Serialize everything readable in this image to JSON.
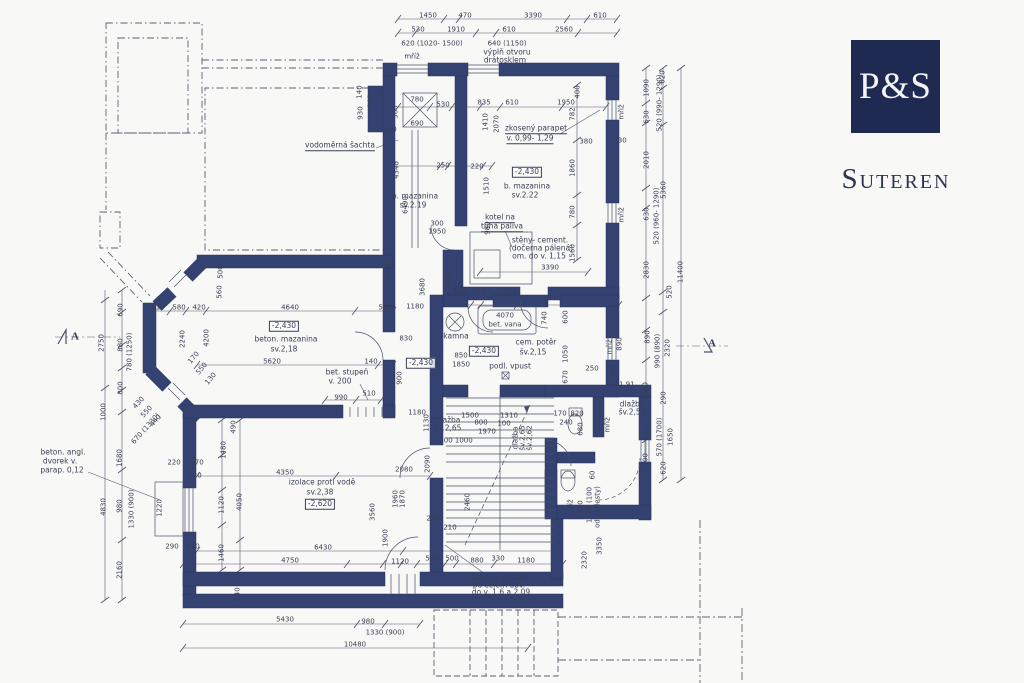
{
  "branding": {
    "monogram": "P&S",
    "title": "Suteren"
  },
  "colors": {
    "wall": "#344271",
    "line": "#565b6e",
    "logo_bg": "#1f2a52",
    "text": "#3a3f55"
  },
  "plan": {
    "texts": [
      [
        "1450",
        428,
        16
      ],
      [
        "470",
        465,
        16
      ],
      [
        "3390",
        533,
        16
      ],
      [
        "610",
        600,
        16
      ],
      [
        "530",
        418,
        30
      ],
      [
        "1910",
        456,
        30
      ],
      [
        "610",
        509,
        30
      ],
      [
        "2560",
        564,
        30
      ],
      [
        "620 (1020- 1500)",
        432,
        44
      ],
      [
        "640 (1150)",
        507,
        44
      ],
      [
        "výplň otvoru",
        507,
        52,
        0,
        "L"
      ],
      [
        "drátosklem",
        505,
        60,
        0,
        "L"
      ],
      [
        "mříž",
        412,
        57
      ],
      [
        "140",
        381,
        95,
        -90
      ],
      [
        "360",
        396,
        112,
        -90
      ],
      [
        "780",
        417,
        100
      ],
      [
        "690",
        417,
        124
      ],
      [
        "530",
        443,
        105
      ],
      [
        "835",
        484,
        103
      ],
      [
        "610",
        512,
        103
      ],
      [
        "1950",
        566,
        103
      ],
      [
        "400",
        578,
        92,
        -90
      ],
      [
        "782",
        573,
        114,
        -90
      ],
      [
        "1410",
        486,
        122,
        -90
      ],
      [
        "2070",
        497,
        124,
        -90
      ],
      [
        "100",
        390,
        130
      ],
      [
        "4340",
        397,
        170,
        -90
      ],
      [
        "6490",
        406,
        205,
        -90
      ],
      [
        "250",
        443,
        166
      ],
      [
        "220",
        477,
        167
      ],
      [
        "1510",
        487,
        186,
        -90
      ],
      [
        "1860",
        573,
        168,
        -90
      ],
      [
        "780",
        573,
        212,
        -90
      ],
      [
        "980",
        488,
        228,
        -90
      ],
      [
        "1560",
        573,
        253,
        -90
      ],
      [
        "300",
        437,
        224
      ],
      [
        "1950",
        437,
        232
      ],
      [
        "3390",
        550,
        268
      ],
      [
        "140",
        360,
        92,
        -90
      ],
      [
        "930",
        361,
        113,
        -90
      ],
      [
        "140",
        371,
        101,
        -90
      ],
      [
        "vodoměrná šachta",
        340,
        146,
        0,
        "Lu"
      ],
      [
        "zkosený parapet",
        536,
        129,
        0,
        "Lu"
      ],
      [
        "v. 0,99- 1,29",
        530,
        139,
        0,
        "Lu"
      ],
      [
        "380",
        586,
        142
      ],
      [
        "230",
        620,
        141
      ],
      [
        "b. mazanina",
        415,
        196,
        0,
        "L"
      ],
      [
        "sv.2.19",
        413,
        205,
        0,
        "L"
      ],
      [
        "-2,430",
        527,
        172,
        0,
        "b"
      ],
      [
        "b. mazanina",
        527,
        186,
        0,
        "L"
      ],
      [
        "sv.2.22",
        525,
        195,
        0,
        "L"
      ],
      [
        "kotel na",
        500,
        218,
        0,
        "Lu"
      ],
      [
        "tuhá paliva",
        502,
        227,
        0,
        "Lu"
      ],
      [
        "stěny- cement.",
        540,
        240,
        0,
        "L"
      ],
      [
        "(dočerna pálená)",
        541,
        248,
        0,
        "L"
      ],
      [
        "om. do v. 1,15",
        539,
        256,
        0,
        "L"
      ],
      [
        "mříž",
        622,
        112,
        -90
      ],
      [
        "mříž",
        622,
        215,
        -90
      ],
      [
        "610",
        158,
        308
      ],
      [
        "580",
        179,
        308
      ],
      [
        "420",
        199,
        308
      ],
      [
        "4640",
        290,
        308
      ],
      [
        "560",
        385,
        308
      ],
      [
        "500",
        221,
        272,
        -90
      ],
      [
        "560",
        220,
        292,
        -90
      ],
      [
        "2750",
        102,
        343,
        -90
      ],
      [
        "690",
        121,
        310,
        -90
      ],
      [
        "880",
        121,
        345,
        -90
      ],
      [
        "780 (1250)",
        130,
        352,
        -90
      ],
      [
        "800",
        121,
        388,
        -90
      ],
      [
        "2240",
        183,
        339,
        -90
      ],
      [
        "4200",
        207,
        338,
        -90
      ],
      [
        "-2,430",
        284,
        326,
        0,
        "b"
      ],
      [
        "beton. mazanina",
        286,
        339,
        0,
        "L"
      ],
      [
        "sv.2,18",
        284,
        349,
        0,
        "L"
      ],
      [
        "5620",
        272,
        362
      ],
      [
        "140",
        371,
        362
      ],
      [
        "170",
        194,
        358,
        -50
      ],
      [
        "550",
        202,
        369,
        -50
      ],
      [
        "130",
        211,
        379,
        -50
      ],
      [
        "bet. stupeň",
        347,
        372,
        0,
        "L"
      ],
      [
        "v. 200",
        340,
        381,
        0,
        "L"
      ],
      [
        "990",
        341,
        398
      ],
      [
        "510",
        369,
        394
      ],
      [
        "komín",
        388,
        270,
        -90
      ],
      [
        "komín",
        449,
        277,
        -90
      ],
      [
        "3680",
        423,
        287,
        -90
      ],
      [
        "1180",
        415,
        307
      ],
      [
        "1180",
        417,
        413
      ],
      [
        "830",
        406,
        339
      ],
      [
        "900",
        400,
        378,
        -90
      ],
      [
        "1130",
        427,
        423,
        -90
      ],
      [
        "860",
        459,
        292
      ],
      [
        "310",
        479,
        292
      ],
      [
        "1120",
        508,
        293
      ],
      [
        "4070",
        505,
        316
      ],
      [
        "bet. vana",
        505,
        325
      ],
      [
        "kamna",
        456,
        336,
        0,
        "L"
      ],
      [
        "-2,430",
        484,
        351,
        0,
        "b"
      ],
      [
        "cem. potěr",
        536,
        342,
        0,
        "L"
      ],
      [
        "šv.2,15",
        533,
        352,
        0,
        "L"
      ],
      [
        "850",
        461,
        356
      ],
      [
        "1850",
        461,
        365
      ],
      [
        "podl. vpust",
        510,
        366,
        0,
        "L"
      ],
      [
        "740",
        545,
        318,
        -90
      ],
      [
        "600",
        566,
        317,
        -90
      ],
      [
        "1050",
        566,
        354,
        -90
      ],
      [
        "670",
        566,
        377,
        -90
      ],
      [
        "250",
        592,
        369
      ],
      [
        "780",
        614,
        371,
        -90
      ],
      [
        "890",
        620,
        344,
        -90
      ],
      [
        "mříž",
        610,
        347,
        -90
      ],
      [
        "-2,430",
        421,
        363,
        0,
        "b"
      ],
      [
        "v.1,91",
        624,
        385
      ],
      [
        "dlažba",
        632,
        404,
        0,
        "L"
      ],
      [
        "šv.2,55",
        632,
        412,
        0,
        "L"
      ],
      [
        "1090",
        647,
        88,
        -90
      ],
      [
        "630",
        647,
        117,
        -90
      ],
      [
        "2010",
        647,
        160,
        -90
      ],
      [
        "630",
        647,
        214,
        -90
      ],
      [
        "2830",
        647,
        270,
        -90
      ],
      [
        "620",
        663,
        77,
        -90
      ],
      [
        "520 (990- 1290)",
        660,
        103,
        -90
      ],
      [
        "5360",
        664,
        190,
        -90
      ],
      [
        "520 (960- 1290)",
        657,
        216,
        -90
      ],
      [
        "520",
        670,
        292,
        -90
      ],
      [
        "11400",
        681,
        272,
        -90
      ],
      [
        "890",
        648,
        337,
        -90
      ],
      [
        "990 (890)",
        658,
        351,
        -90
      ],
      [
        "2320",
        668,
        348,
        -90
      ],
      [
        "1670",
        646,
        391,
        -90
      ],
      [
        "290",
        664,
        398,
        -90
      ],
      [
        "440",
        648,
        433,
        -90
      ],
      [
        "570 (1700)",
        660,
        437,
        -90
      ],
      [
        "1650",
        671,
        437,
        -90
      ],
      [
        "1200",
        646,
        462,
        -90
      ],
      [
        "620",
        664,
        468,
        -90
      ],
      [
        "A",
        75,
        337,
        0,
        "A"
      ],
      [
        "A",
        712,
        344,
        0,
        "A"
      ],
      [
        "beton. angl.",
        63,
        452,
        0,
        "L"
      ],
      [
        "dvorek v.",
        60,
        461,
        0,
        "L"
      ],
      [
        "parap. 0,12",
        62,
        470,
        0,
        "L"
      ],
      [
        "1000",
        104,
        412,
        -90
      ],
      [
        "1680",
        120,
        458,
        -90
      ],
      [
        "4830",
        104,
        507,
        -90
      ],
      [
        "980",
        120,
        506,
        -90
      ],
      [
        "1330 (900)",
        132,
        509,
        -90
      ],
      [
        "2160",
        120,
        570,
        -90
      ],
      [
        "430",
        139,
        403,
        -48
      ],
      [
        "550",
        147,
        412,
        -48
      ],
      [
        "440",
        156,
        421,
        -48
      ],
      [
        "670 (1330)",
        146,
        429,
        -48
      ],
      [
        "1220",
        160,
        508,
        -90
      ],
      [
        "220",
        174,
        463
      ],
      [
        "170",
        197,
        463
      ],
      [
        "220",
        195,
        476
      ],
      [
        "290",
        172,
        547
      ],
      [
        "610",
        193,
        547
      ],
      [
        "1480",
        224,
        450,
        -90
      ],
      [
        "1120",
        222,
        505,
        -90
      ],
      [
        "4050",
        240,
        502,
        -90
      ],
      [
        "1460",
        222,
        553,
        -90
      ],
      [
        "490",
        234,
        427,
        -90
      ],
      [
        "izolace proti vodě",
        322,
        482,
        0,
        "L"
      ],
      [
        "sv.2,38",
        320,
        492,
        0,
        "L"
      ],
      [
        "-2,620",
        320,
        504,
        0,
        "b"
      ],
      [
        "4350",
        285,
        473
      ],
      [
        "3560",
        373,
        512,
        -90
      ],
      [
        "1900",
        386,
        538,
        -90
      ],
      [
        "1960",
        396,
        499,
        -90
      ],
      [
        "1870",
        403,
        499,
        -90
      ],
      [
        "2080",
        404,
        470
      ],
      [
        "2090",
        428,
        464,
        -90
      ],
      [
        "640",
        238,
        594,
        -90
      ],
      [
        "6430",
        323,
        548
      ],
      [
        "4750",
        290,
        561
      ],
      [
        "1120",
        400,
        562
      ],
      [
        "560",
        432,
        559
      ],
      [
        "500",
        452,
        559
      ],
      [
        "880",
        477,
        561
      ],
      [
        "330",
        498,
        559
      ],
      [
        "1180",
        526,
        561
      ],
      [
        "5430",
        285,
        620
      ],
      [
        "980",
        368,
        622
      ],
      [
        "1330 (900)",
        385,
        633
      ],
      [
        "10480",
        355,
        645
      ],
      [
        "keram. obklad",
        500,
        577,
        0,
        "L"
      ],
      [
        "po celém obv.",
        499,
        585,
        0,
        "L"
      ],
      [
        "do v. 1,6 a 2,09",
        501,
        593,
        0,
        "Lu"
      ],
      [
        "290",
        433,
        519
      ],
      [
        "210",
        450,
        528
      ],
      [
        "2460",
        468,
        502,
        -90
      ],
      [
        "mříž",
        571,
        507,
        -90
      ],
      [
        "870",
        581,
        507,
        -90
      ],
      [
        "1160 (100",
        590,
        505,
        -90
      ],
      [
        "od podesty)",
        598,
        507,
        -90
      ],
      [
        "2320",
        585,
        560,
        -90
      ],
      [
        "3350",
        600,
        546,
        -90
      ],
      [
        "60",
        593,
        475,
        -90
      ],
      [
        "dlažba",
        448,
        420,
        0,
        "L"
      ],
      [
        "šv.2,65",
        448,
        428,
        0,
        "L"
      ],
      [
        "500 1000",
        456,
        441
      ],
      [
        "1500",
        470,
        416
      ],
      [
        "800",
        481,
        423
      ],
      [
        "1310",
        509,
        416
      ],
      [
        "100",
        504,
        424
      ],
      [
        "1970",
        487,
        432
      ],
      [
        "dlažba",
        516,
        438,
        -90
      ],
      [
        "šv.2,65",
        523,
        438,
        -90
      ],
      [
        "šv.2,62",
        530,
        438,
        -90
      ],
      [
        "170",
        560,
        414
      ],
      [
        "820",
        577,
        414
      ],
      [
        "240",
        566,
        423
      ],
      [
        "680",
        581,
        429,
        -90
      ],
      [
        "mříž",
        608,
        425,
        -90
      ]
    ]
  }
}
